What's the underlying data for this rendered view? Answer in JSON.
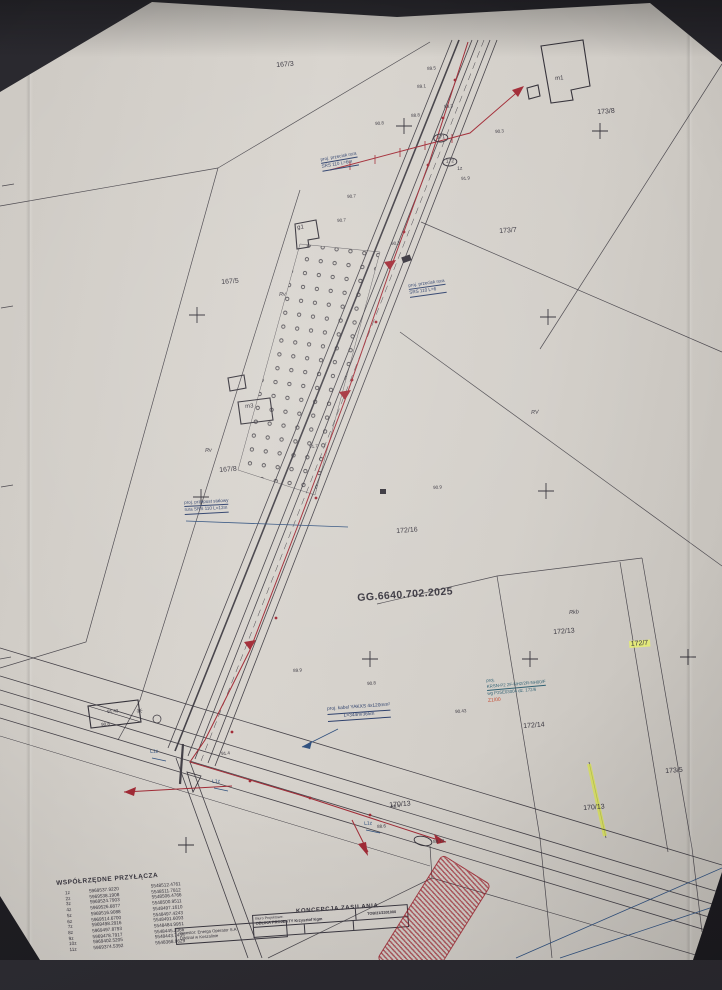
{
  "colors": {
    "ink": "#35323a",
    "red": "#a22b36",
    "blue": "#30517f",
    "teal": "#2f6072",
    "highlight": "#e6ee7a",
    "paper": "#d5d1c9"
  },
  "map": {
    "case_number": "GG.6640.702.2025",
    "labels": [
      {
        "t": "167/3",
        "x": 276,
        "y": 62,
        "fs": 7
      },
      {
        "t": "173/8",
        "x": 597,
        "y": 109,
        "fs": 7
      },
      {
        "t": "173/7",
        "x": 499,
        "y": 228,
        "fs": 7
      },
      {
        "t": "167/5",
        "x": 221,
        "y": 279,
        "fs": 7
      },
      {
        "t": "167/8",
        "x": 219,
        "y": 467,
        "fs": 7
      },
      {
        "t": "172/16",
        "x": 396,
        "y": 528,
        "fs": 7
      },
      {
        "t": "172/13",
        "x": 553,
        "y": 629,
        "fs": 7
      },
      {
        "t": "172/7",
        "x": 629,
        "y": 641,
        "fs": 7,
        "hl": 1
      },
      {
        "t": "172/14",
        "x": 523,
        "y": 723,
        "fs": 7
      },
      {
        "t": "170/13",
        "x": 389,
        "y": 802,
        "fs": 7
      },
      {
        "t": "170/13",
        "x": 583,
        "y": 805,
        "fs": 7
      },
      {
        "t": "173/5",
        "x": 665,
        "y": 768,
        "fs": 7
      },
      {
        "t": "GG.6640.702.2025",
        "x": 357,
        "y": 593,
        "fs": 10.5,
        "b": 1
      },
      {
        "t": "m1",
        "x": 555,
        "y": 76,
        "fs": 6
      },
      {
        "t": "g1",
        "x": 297,
        "y": 225,
        "fs": 6
      },
      {
        "t": "m3",
        "x": 245,
        "y": 404,
        "fs": 6
      },
      {
        "t": "Rv",
        "x": 279,
        "y": 293,
        "fs": 5.5,
        "i": 1
      },
      {
        "t": "Rv",
        "x": 205,
        "y": 449,
        "fs": 5.5,
        "i": 1
      },
      {
        "t": "RV",
        "x": 531,
        "y": 411,
        "fs": 5.5,
        "i": 1
      },
      {
        "t": "Rkb",
        "x": 569,
        "y": 611,
        "fs": 5.5,
        "i": 1
      },
      {
        "t": "1z",
        "x": 457,
        "y": 167,
        "fs": 5
      },
      {
        "t": "171",
        "x": 433,
        "y": 134,
        "fs": 5,
        "circ": 1
      },
      {
        "t": "172",
        "x": 442,
        "y": 158,
        "fs": 5,
        "circ": 1
      },
      {
        "t": "L1z",
        "x": 150,
        "y": 750,
        "fs": 5,
        "c": "blue"
      },
      {
        "t": "L1z",
        "x": 212,
        "y": 780,
        "fs": 5,
        "c": "blue"
      },
      {
        "t": "L1z",
        "x": 364,
        "y": 822,
        "fs": 5,
        "c": "blue"
      },
      {
        "t": "✳",
        "x": 136,
        "y": 708,
        "fs": 8
      },
      {
        "t": "89.5",
        "x": 427,
        "y": 67,
        "fs": 4.5
      },
      {
        "t": "89.1",
        "x": 417,
        "y": 85,
        "fs": 4.5
      },
      {
        "t": "89.3",
        "x": 444,
        "y": 105,
        "fs": 4.5
      },
      {
        "t": "88.8",
        "x": 411,
        "y": 114,
        "fs": 4.5
      },
      {
        "t": "90.8",
        "x": 375,
        "y": 122,
        "fs": 4.5
      },
      {
        "t": "90.3",
        "x": 495,
        "y": 130,
        "fs": 4.5
      },
      {
        "t": "91.9",
        "x": 461,
        "y": 177,
        "fs": 4.5
      },
      {
        "t": "90.7",
        "x": 347,
        "y": 195,
        "fs": 4.5
      },
      {
        "t": "90.7",
        "x": 337,
        "y": 219,
        "fs": 4.5
      },
      {
        "t": "90.3",
        "x": 391,
        "y": 242,
        "fs": 4.5
      },
      {
        "t": "91.7",
        "x": 309,
        "y": 445,
        "fs": 4.5
      },
      {
        "t": "90.9",
        "x": 433,
        "y": 486,
        "fs": 4.5
      },
      {
        "t": "89.9",
        "x": 293,
        "y": 669,
        "fs": 4.5
      },
      {
        "t": "90.8",
        "x": 367,
        "y": 682,
        "fs": 4.5
      },
      {
        "t": "90.43",
        "x": 455,
        "y": 710,
        "fs": 4.5
      },
      {
        "t": "91.43",
        "x": 107,
        "y": 710,
        "fs": 4.5
      },
      {
        "t": "90.8",
        "x": 101,
        "y": 723,
        "fs": 4.5
      },
      {
        "t": "91.4",
        "x": 221,
        "y": 752,
        "fs": 4.5
      },
      {
        "t": "88.4",
        "x": 391,
        "y": 805,
        "fs": 4.5
      },
      {
        "t": "88.6",
        "x": 377,
        "y": 825,
        "fs": 4.5
      },
      {
        "t": "88.73",
        "x": 433,
        "y": 840,
        "fs": 4.5
      }
    ],
    "annotations": {
      "a1": {
        "lines": [
          "proj. przecisk rura",
          "SRS 110 L=6m"
        ]
      },
      "a2": {
        "lines": [
          "proj. przecisk rura",
          "SRS 110 L=6"
        ]
      },
      "a3": {
        "lines": [
          "proj. przepust stalowy",
          "rura SRS 110 L=12m"
        ]
      },
      "a4": {
        "lines": [
          "proj. kabel YAKXS 4x120mm²",
          "L=344m/365m"
        ]
      },
      "a5": {
        "lines": [
          "proj.",
          "KRSN-P2 2F-NH2/2R-NH00/F",
          "wg P25E03004 dz. 172/6"
        ],
        "extra": "Z1/00"
      }
    }
  },
  "coords_table": {
    "title": "WSPÓŁRZĘDNE PRZYŁĄCZA",
    "rows": [
      [
        "1z",
        "5969537.9220",
        "5548512.4761"
      ],
      [
        "2z",
        "5969538.1908",
        "5548511.7812"
      ],
      [
        "3z",
        "5969524.7903",
        "5548506.4766"
      ],
      [
        "4z",
        "5969526.6877",
        "5548500.9511"
      ],
      [
        "5z",
        "5969516.9088",
        "5548497.1610"
      ],
      [
        "6z",
        "5969514.6700",
        "5548497.4243"
      ],
      [
        "7z",
        "5969498.2916",
        "5548491.6093"
      ],
      [
        "8z",
        "5969497.8793",
        "5548484.9951"
      ],
      [
        "9z",
        "5969478.7917",
        "5548445.2366"
      ],
      [
        "10z",
        "5969402.5205",
        "5548443.7435"
      ],
      [
        "11z",
        "5969374.5392",
        "5548368.9629"
      ]
    ]
  },
  "title_block": {
    "heading": "KONCEPCJA ZASILANIA",
    "doc_no": "TOB/21/2301000",
    "designer_label": "Biuro Projektowe:",
    "designer": "OBLIKA PROJEKTY Krzysztof Kgm",
    "investor_line1": "Inwestor: Energa Operator S.A",
    "investor_line2": "Oddział w Koszalinie"
  }
}
